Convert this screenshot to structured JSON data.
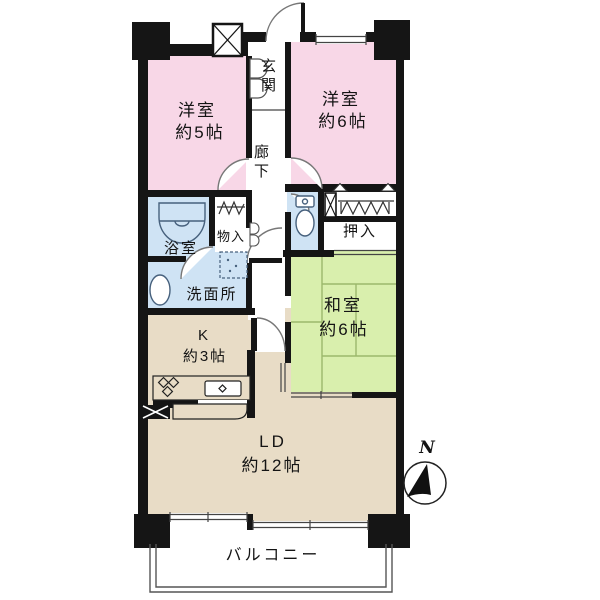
{
  "plan": {
    "rooms": {
      "bedroom5": {
        "name": "洋室",
        "size": "約5帖"
      },
      "bedroom6": {
        "name": "洋室",
        "size": "約6帖"
      },
      "japanese_room": {
        "name": "和室",
        "size": "約6帖"
      },
      "kitchen": {
        "name": "K",
        "size": "約3帖"
      },
      "living_dining": {
        "name": "LD",
        "size": "約12帖"
      },
      "entrance": "玄関",
      "hallway": "廊下",
      "bathroom": "浴室",
      "washroom": "洗面所",
      "storage": "物入",
      "closet": "押入",
      "balcony": "バルコニー"
    },
    "compass": {
      "north": "N"
    },
    "colors": {
      "wall": "#151515",
      "bedroom": "#f8d7e7",
      "japanese_room": "#d9efad",
      "living": "#e8dcc6",
      "wet_area": "#cfe3f4",
      "tatami_line": "#9cb86c",
      "line": "#555555"
    }
  }
}
